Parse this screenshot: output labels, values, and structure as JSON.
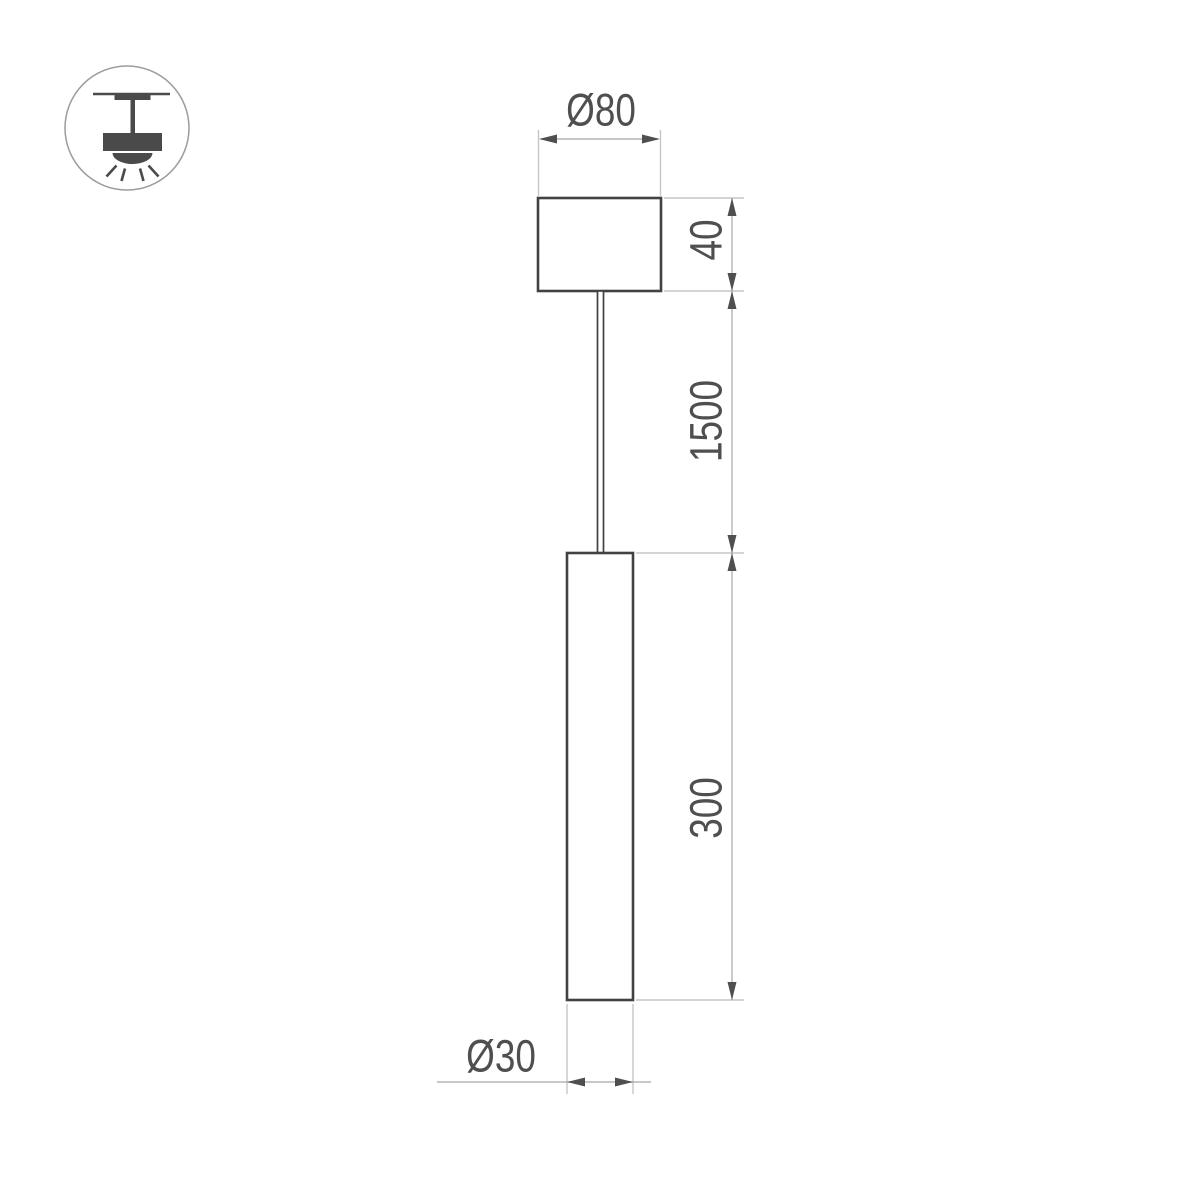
{
  "drawing": {
    "type": "technical-dimension-drawing",
    "subject": "pendant-tube-luminaire",
    "labels": {
      "canopy_diameter": "Ø80",
      "canopy_height": "40",
      "suspension_length": "1500",
      "tube_length": "300",
      "tube_diameter": "Ø30"
    },
    "values_mm": {
      "canopy_diameter": 80,
      "canopy_height": 40,
      "suspension_length": 1500,
      "tube_length": 300,
      "tube_diameter": 30
    }
  },
  "icon": {
    "name": "ceiling-pendant-light-icon",
    "meaning": "surface ceiling mounted pendant luminaire"
  },
  "colors": {
    "background": "#ffffff",
    "object_line": "#424242",
    "dimension_line": "#b5b5b5",
    "extension_line": "#c6c6c6",
    "arrow_and_text": "#4f4f4f",
    "icon_fill": "#4a4a4a",
    "icon_circle_stroke": "#9c9c9c"
  }
}
